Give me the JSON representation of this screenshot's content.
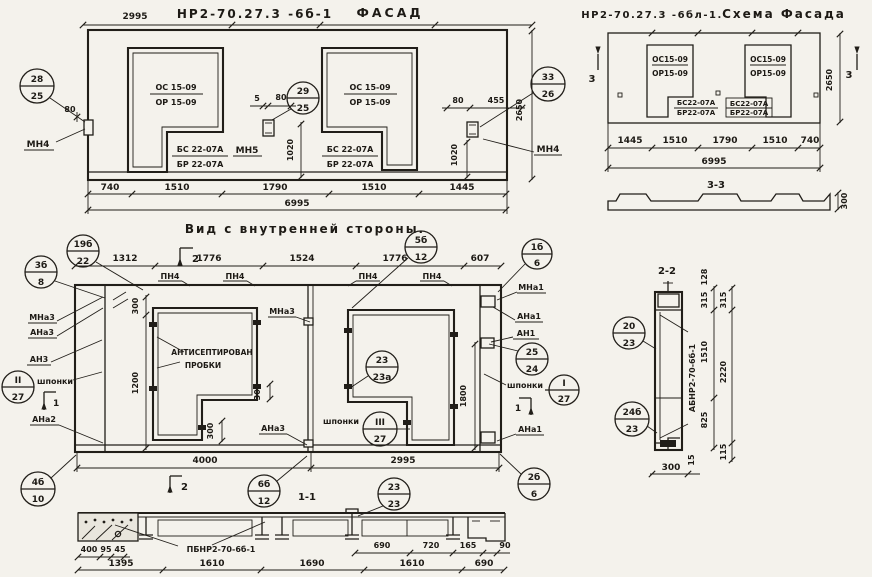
{
  "facade": {
    "title_code": "НР2-70.27.3 -6б-1",
    "title_name": "ФАСАД",
    "dim_2995": "2995",
    "opening_top": "ОС 15-09",
    "opening_bot": "ОР 15-09",
    "insert_top": "БС 22-07А",
    "insert_bot": "БР 22-07А",
    "label_mn4_left": "МН4",
    "label_mn5": "МН5",
    "label_mn4_right": "МН4",
    "dim_80_left": "80",
    "dim_5_mid": "5",
    "dim_80_mid": "80",
    "dim_80_right": "80",
    "dim_455": "455",
    "dim_1020_mid": "1020",
    "dim_1020_right": "1020",
    "dim_2650": "2650",
    "dims_bottom": [
      "740",
      "1510",
      "1790",
      "1510",
      "1445"
    ],
    "dim_total": "6995",
    "callout_left": {
      "top": "28",
      "bot": "25"
    },
    "callout_mid": {
      "top": "29",
      "bot": "25"
    },
    "callout_right": {
      "top": "33",
      "bot": "26"
    }
  },
  "scheme": {
    "title_code": "НР2-70.27.3 -6бл-1.",
    "title_name": "Схема Фасада",
    "opening_top": "ОС15-09",
    "opening_bot": "ОР15-09",
    "insert_top": "БС22-07А",
    "insert_bot": "БР22-07А",
    "mark_left": "3",
    "mark_right": "3",
    "dim_2650": "2650",
    "dims_bottom": [
      "1445",
      "1510",
      "1790",
      "1510",
      "740"
    ],
    "dim_total": "6995",
    "section33_label": "3-3",
    "section33_dim": "300"
  },
  "inner": {
    "title": "Вид с внутренней стороны.",
    "dims_top": [
      "1312",
      "1776",
      "1524",
      "1776",
      "607"
    ],
    "pn4": "ПН4",
    "marker2_top": "2",
    "marker2_bottom": "2",
    "marker1_left": "1",
    "marker1_right": "1",
    "callouts": {
      "c19b22": {
        "top": "19б",
        "bot": "22"
      },
      "c5b12": {
        "top": "5б",
        "bot": "12"
      },
      "c1b6": {
        "top": "1б",
        "bot": "6"
      },
      "c3b8": {
        "top": "3б",
        "bot": "8"
      },
      "cII27": {
        "top": "II",
        "bot": "27"
      },
      "cIII27": {
        "top": "III",
        "bot": "27"
      },
      "c2323a": {
        "top": "23",
        "bot": "23а"
      },
      "c2524": {
        "top": "25",
        "bot": "24"
      },
      "cI27": {
        "top": "I",
        "bot": "27"
      },
      "c4b10": {
        "top": "4б",
        "bot": "10"
      },
      "c6b12": {
        "top": "6б",
        "bot": "12"
      },
      "c2b6": {
        "top": "2б",
        "bot": "6"
      }
    },
    "left": {
      "mna3": "МНа3",
      "ana3": "АНа3",
      "an3": "АН3",
      "shponki": "шпонки",
      "ana2": "АНа2"
    },
    "middle": {
      "mna3": "МНа3",
      "ana3": "АНа3",
      "shponki": "шпонки",
      "note1": "АНТИСЕПТИРОВАН",
      "note2": "ПРОБКИ"
    },
    "right": {
      "mna1": "МНа1",
      "ana1_top": "АНа1",
      "an1": "АН1",
      "shponki": "шпонки",
      "ana1_bot": "АНа1"
    },
    "dim_300_left": "300",
    "dim_1200": "1200",
    "dim_300_a": "300",
    "dim_300_b": "300",
    "dim_1800": "1800",
    "dim_4000": "4000",
    "dim_2995": "2995"
  },
  "section11": {
    "label": "1-1",
    "callout": {
      "top": "23",
      "bot": "23"
    },
    "part_label": "ПБНР2-70-6б-1",
    "dims_upper_left": [
      "400",
      "95",
      "45"
    ],
    "dims_upper_right": [
      "690",
      "720",
      "165",
      "90"
    ],
    "dims_lower": [
      "1395",
      "1610",
      "1690",
      "1610",
      "690"
    ]
  },
  "section22": {
    "label": "2-2",
    "part_label": "АБНР2-70-6б-1",
    "callout_top": {
      "top": "20",
      "bot": "23"
    },
    "callout_bot": {
      "top": "24б",
      "bot": "23"
    },
    "dim_128": "128",
    "dim_315_a": "315",
    "dim_315_b": "315",
    "dim_1510": "1510",
    "dim_2220": "2220",
    "dim_825": "825",
    "dim_115": "115",
    "dim_300": "300",
    "dim_15": "15"
  }
}
